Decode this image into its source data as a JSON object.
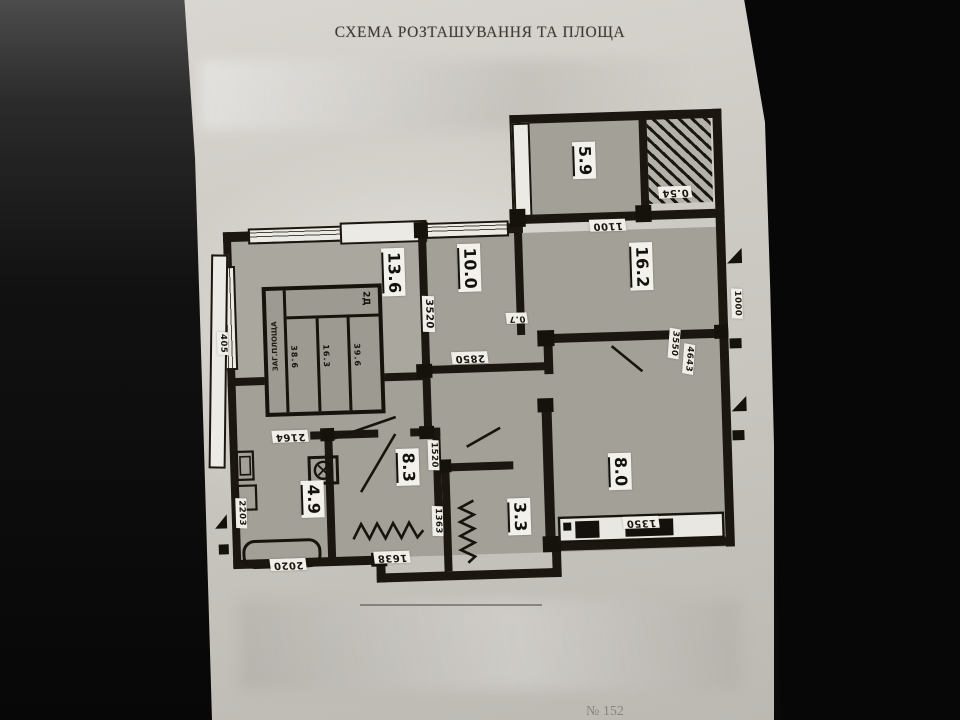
{
  "photo": {
    "title": "СХЕМА РОЗТАШУВАННЯ ТА ПЛОЩА",
    "footer_note": "№ 152"
  },
  "rooms": [
    {
      "key": "room-top",
      "area": "5.9"
    },
    {
      "key": "room-large",
      "area": "16.2"
    },
    {
      "key": "room-living",
      "area": "13.6"
    },
    {
      "key": "corridor",
      "area": "10.0"
    },
    {
      "key": "hall-room",
      "area": "8.3"
    },
    {
      "key": "bathroom",
      "area": "4.9"
    },
    {
      "key": "wc",
      "area": "3.3"
    },
    {
      "key": "kitchen",
      "area": "8.0"
    },
    {
      "key": "loggia",
      "area": "0.54"
    }
  ],
  "dims": {
    "w1100": "1100",
    "v3520": "3520",
    "w2850": "2850",
    "s07": "0.7",
    "v3550": "3550",
    "v4643": "4643",
    "v1520": "1520",
    "w2164": "2164",
    "w2020": "2020",
    "w1638": "1638",
    "v1363": "1363",
    "v2203": "2203",
    "w3482": "3482",
    "w1350": "1350",
    "v405": "405",
    "v1000": "1000"
  },
  "stamp": {
    "side": "ЗАГ.ПЛОЩА",
    "head": "2Д",
    "col1": "38.6",
    "col2": "16.3",
    "col3": "39.6"
  }
}
